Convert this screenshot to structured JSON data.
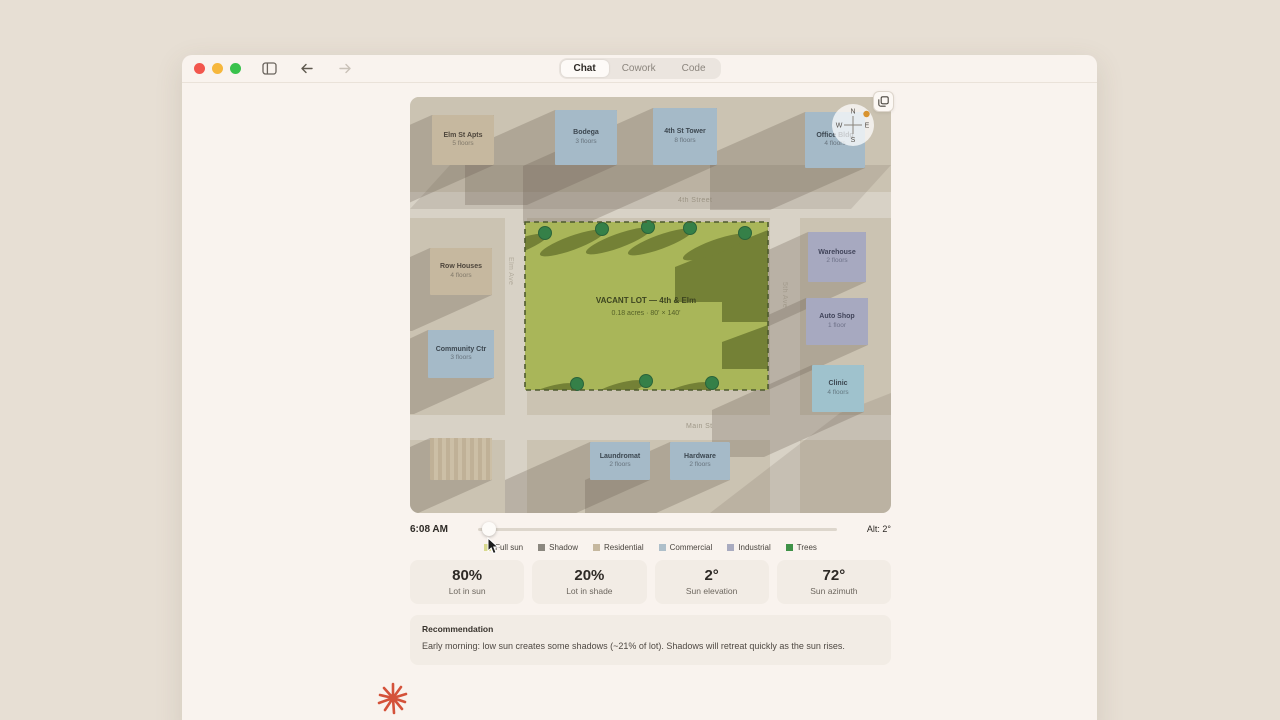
{
  "window": {
    "tabs": [
      {
        "label": "Chat"
      },
      {
        "label": "Cowork"
      },
      {
        "label": "Code"
      }
    ]
  },
  "map": {
    "compass": {
      "n": "N",
      "e": "E",
      "s": "S",
      "w": "W"
    },
    "streets": {
      "top": "4th Street",
      "bottom": "Main St",
      "left": "Elm Ave",
      "right": "5th Ave"
    },
    "lot": {
      "title": "VACANT LOT — 4th & Elm",
      "subtitle": "0.18 acres · 80' × 140'"
    },
    "buildings": [
      {
        "name": "Elm St Apts",
        "floors": "5 floors",
        "type": "residential"
      },
      {
        "name": "Bodega",
        "floors": "3 floors",
        "type": "commercial"
      },
      {
        "name": "4th St Tower",
        "floors": "8 floors",
        "type": "commercial"
      },
      {
        "name": "Office Bldg",
        "floors": "4 floors",
        "type": "commercial"
      },
      {
        "name": "Row Houses",
        "floors": "4 floors",
        "type": "residential"
      },
      {
        "name": "Community Ctr",
        "floors": "3 floors",
        "type": "commercial"
      },
      {
        "name": "Warehouse",
        "floors": "2 floors",
        "type": "industrial"
      },
      {
        "name": "Auto Shop",
        "floors": "1 floor",
        "type": "industrial"
      },
      {
        "name": "Clinic",
        "floors": "4 floors",
        "type": "commercial"
      },
      {
        "name": "Laundromat",
        "floors": "2 floors",
        "type": "commercial"
      },
      {
        "name": "Hardware",
        "floors": "2 floors",
        "type": "commercial"
      }
    ]
  },
  "controls": {
    "time": "6:08 AM",
    "altitude": "Alt: 2°"
  },
  "legend": {
    "items": [
      {
        "label": "Full sun",
        "color": "#d9d98e"
      },
      {
        "label": "Shadow",
        "color": "#8b877f"
      },
      {
        "label": "Residential",
        "color": "#c6b89f"
      },
      {
        "label": "Commercial",
        "color": "#aebfca"
      },
      {
        "label": "Industrial",
        "color": "#a9abc0"
      },
      {
        "label": "Trees",
        "color": "#3f9248"
      }
    ]
  },
  "stats": [
    {
      "value": "80%",
      "label": "Lot in sun"
    },
    {
      "value": "20%",
      "label": "Lot in shade"
    },
    {
      "value": "2°",
      "label": "Sun elevation"
    },
    {
      "value": "72°",
      "label": "Sun azimuth"
    }
  ],
  "recommendation": {
    "heading": "Recommendation",
    "body": "Early morning: low sun creates some shadows (~21% of lot). Shadows will retreat quickly as the sun rises."
  },
  "colors": {
    "page_bg": "#e7dfd4",
    "window_bg": "#f9f3ee",
    "lot_green": "#a9b659",
    "shadow_olive": "#6b7830",
    "tree_green": "#358048",
    "sun_orange": "#d8932f",
    "starburst_red": "#d4523a"
  }
}
